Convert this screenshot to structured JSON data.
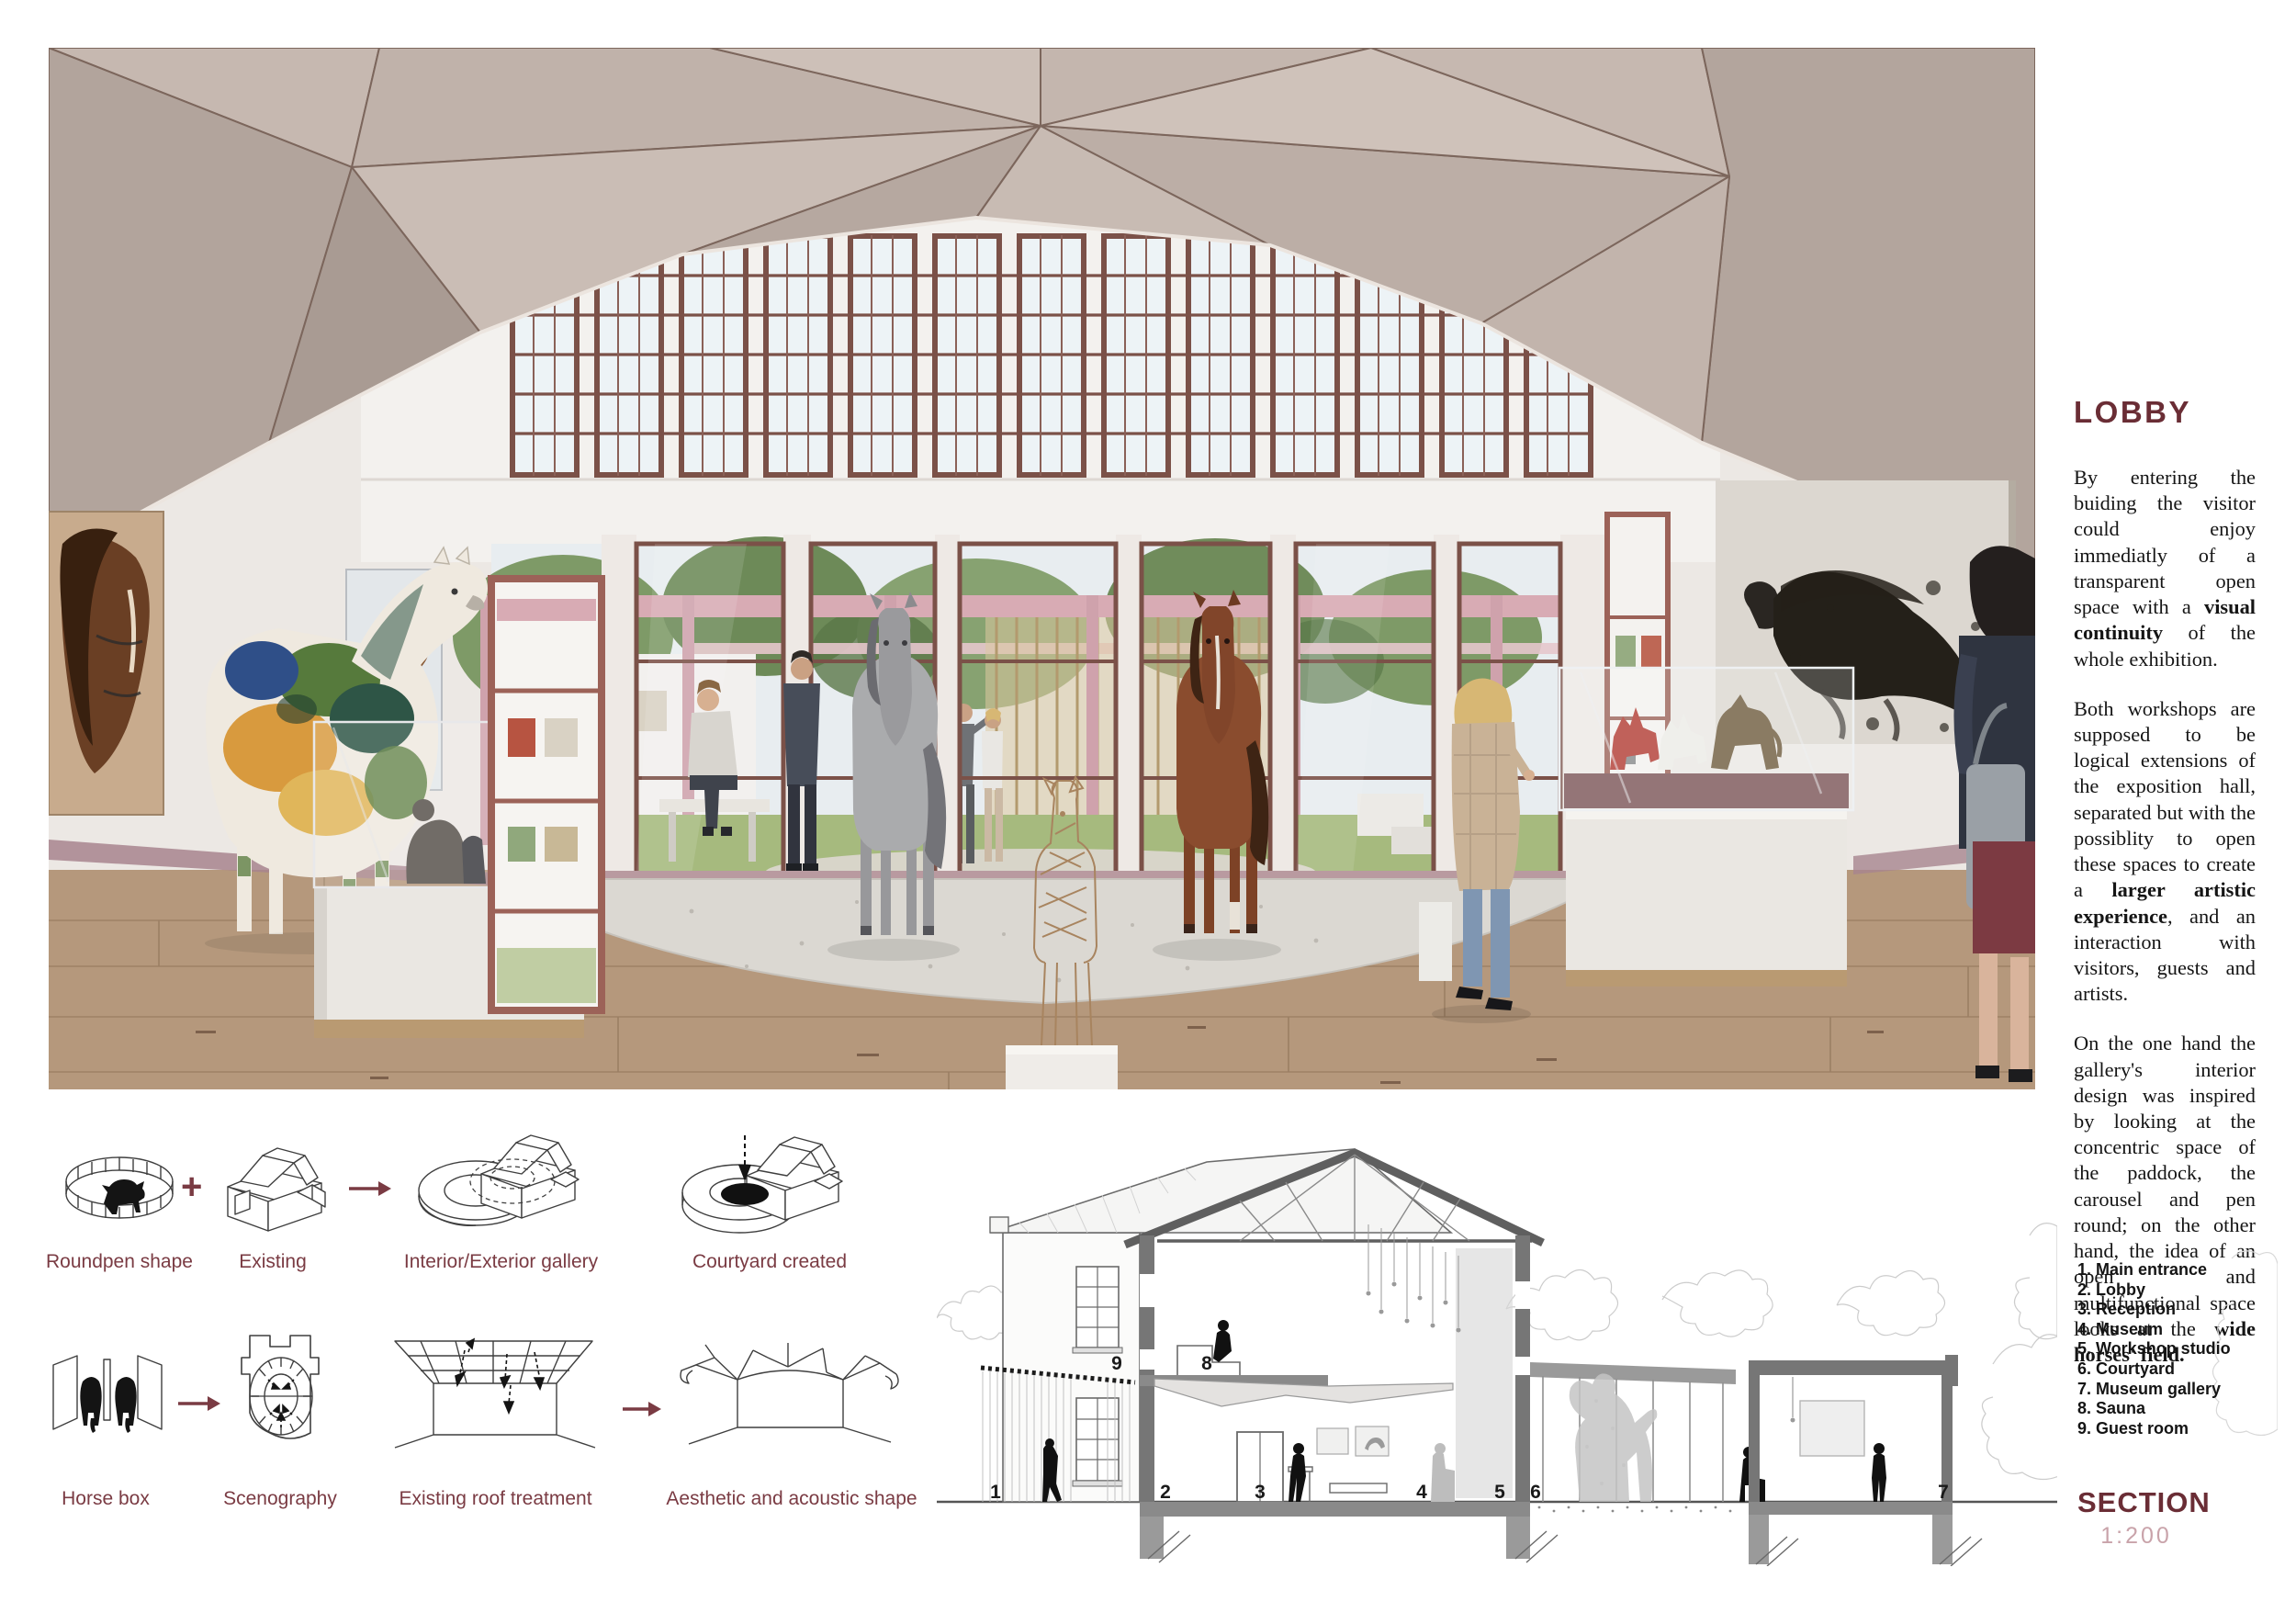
{
  "colors": {
    "accent_maroon": "#6a2d35",
    "label_maroon": "#7a3b43",
    "scale_muted": "#c9a3aa",
    "body_text": "#151515",
    "window_frame_brown": "#7b5148",
    "courtyard_pink": "#d6a8b0",
    "ceiling_taupe": "#b5a79f"
  },
  "lobby_panel": {
    "heading": "LOBBY",
    "paragraphs": [
      [
        {
          "t": "By entering the buiding the visitor could enjoy immediatly of a transparent open space with a "
        },
        {
          "t": "visual continuity",
          "b": true
        },
        {
          "t": " of the whole exhibition."
        }
      ],
      [
        {
          "t": "Both workshops are supposed to be logical extensions of the exposition hall, separated but with the possiblity to open these spaces to create a "
        },
        {
          "t": "larger artistic experience",
          "b": true
        },
        {
          "t": ", and an interaction with visitors, guests and artists."
        }
      ],
      [
        {
          "t": "On the one hand the gallery's interior design was inspired by looking at the concentric space of the paddock, the carousel and pen round; on the other hand, the idea of an open and multifunctional space looks at the "
        },
        {
          "t": "wide horses' field.",
          "b": true
        }
      ]
    ]
  },
  "diagrams": {
    "plus_sign": "+",
    "row1_labels": [
      "Roundpen shape",
      "Existing",
      "Interior/Exterior gallery",
      "Courtyard created"
    ],
    "row2_labels": [
      "Horse box",
      "Scenography",
      "Existing roof treatment",
      "Aesthetic and acoustic shape"
    ]
  },
  "section": {
    "title": "SECTION",
    "scale": "1:200",
    "legend": [
      "1. Main entrance",
      "2. Lobby",
      "3. Reception",
      "4. Museum",
      "5. Workshop studio",
      "6. Courtyard",
      "7. Museum gallery",
      "8. Sauna",
      "9. Guest room"
    ],
    "markers": [
      "1",
      "2",
      "3",
      "4",
      "5",
      "6",
      "7",
      "8",
      "9"
    ]
  }
}
